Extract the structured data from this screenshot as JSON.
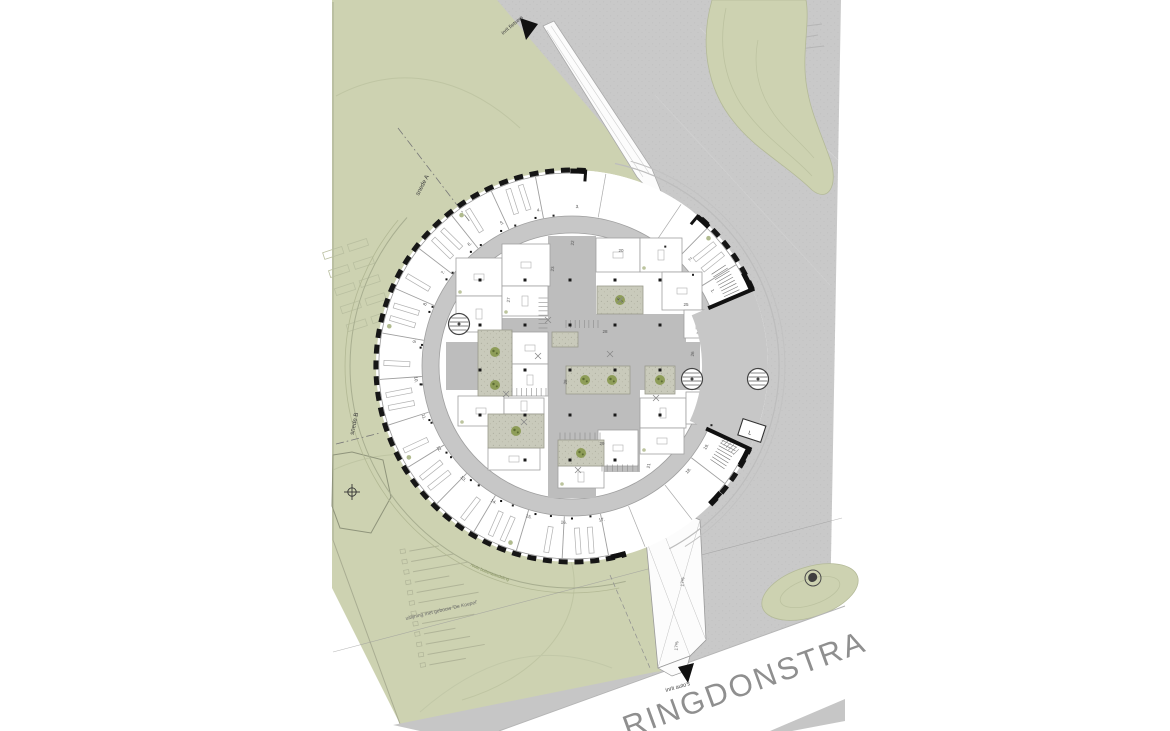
{
  "site": {
    "labels": {
      "section_a": "snede A",
      "section_b": "snede B",
      "bike_entrance": "inrit fietsers",
      "car_entrance": "inrit auto's",
      "alignment_note": "uitlijning met gebouw 'De Koepel'",
      "walk_route_note": "route buitenwandeling",
      "ramp_grade_upper": "17%",
      "ramp_grade_lower": "17%",
      "street_name": "RINGDONSTRA",
      "elevator_mark": "L"
    },
    "colors": {
      "white": "#ffffff",
      "green": "#cdd2b1",
      "green_line": "#b2b894",
      "plaza": "#c9c9c9",
      "sidewalk": "#c4c4c4",
      "corridor": "#c7c7c7",
      "circulation": "#bdbdbd",
      "gravel": "#c9cabb",
      "gravel_dot": "#a5a596",
      "tree": "#87984e",
      "tree_dark": "#5c6b33",
      "facade": "#161616",
      "wall": "#9f9f9f",
      "furniture": "#b0b0b0",
      "text_dark": "#3f3f3f",
      "text_mid": "#5a5a5a",
      "street_text": "#8f8f8f"
    }
  },
  "building": {
    "ring_room_numbers": [
      "1.",
      "2.",
      "3.",
      "4.",
      "5.",
      "6.",
      "7.",
      "8.",
      "9.",
      "10.",
      "11.",
      "12.",
      "13.",
      "14.",
      "15.",
      "16.",
      "17.",
      "18.",
      "19."
    ],
    "core_room_numbers": [
      "20",
      "21",
      "22",
      "23",
      "24",
      "25",
      "26",
      "27",
      "28",
      "28",
      "29"
    ]
  }
}
